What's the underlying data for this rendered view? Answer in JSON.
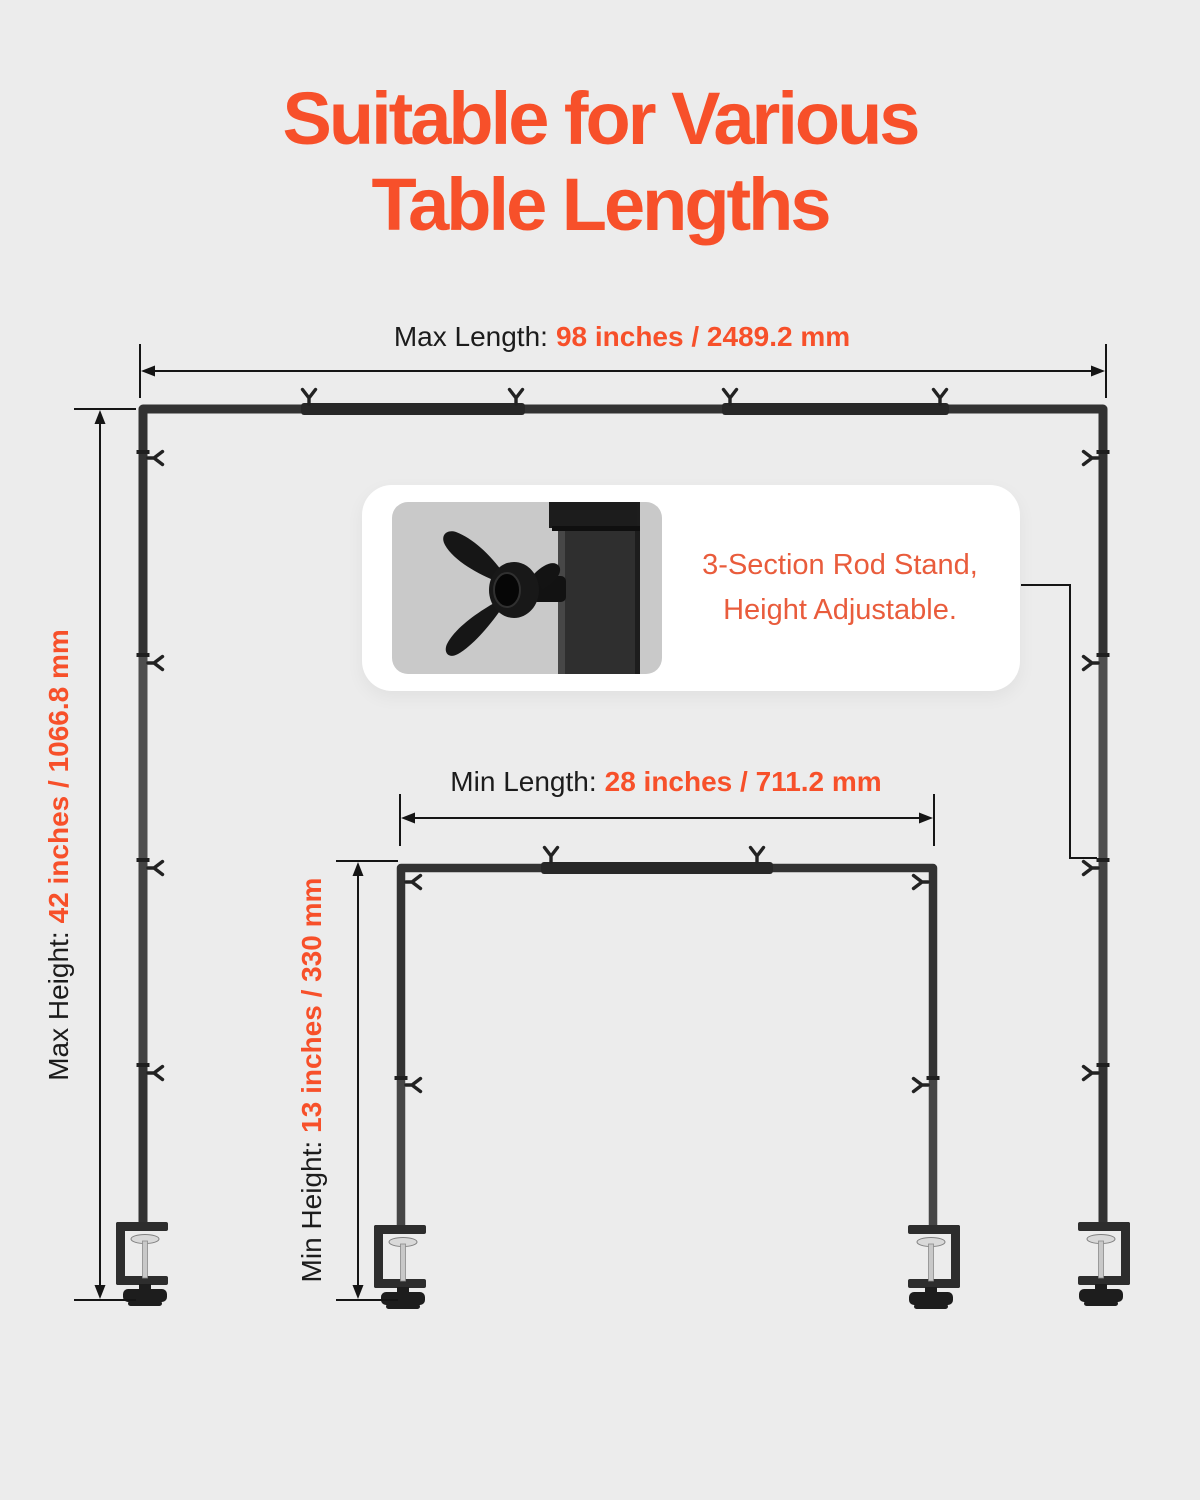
{
  "title": {
    "line1": "Suitable for Various",
    "line2": "Table Lengths"
  },
  "labels": {
    "max_length": {
      "label": "Max Length:",
      "value": "98 inches / 2489.2 mm"
    },
    "max_height": {
      "label": "Max Height:",
      "value": "42 inches / 1066.8 mm"
    },
    "min_length": {
      "label": "Min Length:",
      "value": "28 inches / 711.2 mm"
    },
    "min_height": {
      "label": "Min Height:",
      "value": "13 inches / 330 mm"
    }
  },
  "callout": {
    "line1": "3-Section Rod Stand,",
    "line2": "Height Adjustable."
  },
  "colors": {
    "background": "#ececec",
    "accent_orange": "#f7502a",
    "callout_orange": "#e95c3c",
    "label_black": "#1c1c1c",
    "frame_dark": "#323232",
    "dimension_line": "#151515",
    "callout_card": "#ffffff",
    "callout_image_bg": "#c9c9c9"
  }
}
